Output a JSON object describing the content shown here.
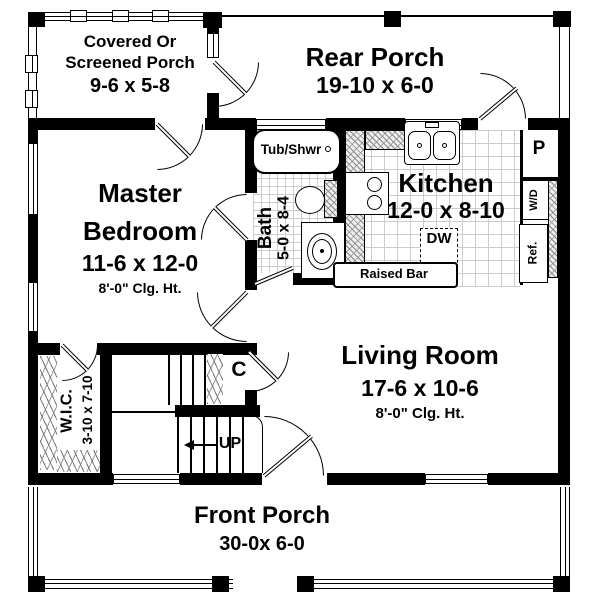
{
  "rooms": {
    "covered_porch": {
      "line1": "Covered Or",
      "line2": "Screened Porch",
      "dims": "9-6 x 5-8"
    },
    "rear_porch": {
      "name": "Rear Porch",
      "dims": "19-10 x 6-0"
    },
    "master_bedroom": {
      "line1": "Master",
      "line2": "Bedroom",
      "dims": "11-6 x 12-0",
      "ceiling": "8'-0\" Clg. Ht."
    },
    "bath": {
      "name": "Bath",
      "dims": "5-0 x 8-4"
    },
    "kitchen": {
      "name": "Kitchen",
      "dims": "12-0 x 8-10"
    },
    "living_room": {
      "name": "Living Room",
      "dims": "17-6 x 10-6",
      "ceiling": "8'-0\" Clg. Ht."
    },
    "wic": {
      "name": "W.I.C.",
      "dims": "3-10 x 7-10"
    },
    "front_porch": {
      "name": "Front Porch",
      "dims": "30-0x 6-0"
    }
  },
  "fixtures": {
    "tub_shower": "Tub/Shwr",
    "dishwasher": "DW",
    "raised_bar": "Raised Bar",
    "pantry": "P",
    "washer_dryer": "W/D",
    "refrigerator": "Ref.",
    "closet": "C",
    "stairs": "UP"
  },
  "colors": {
    "wall": "#000000",
    "floor": "#ffffff",
    "tile_line": "#cccccc",
    "hatch_line": "#8a8a8a"
  }
}
